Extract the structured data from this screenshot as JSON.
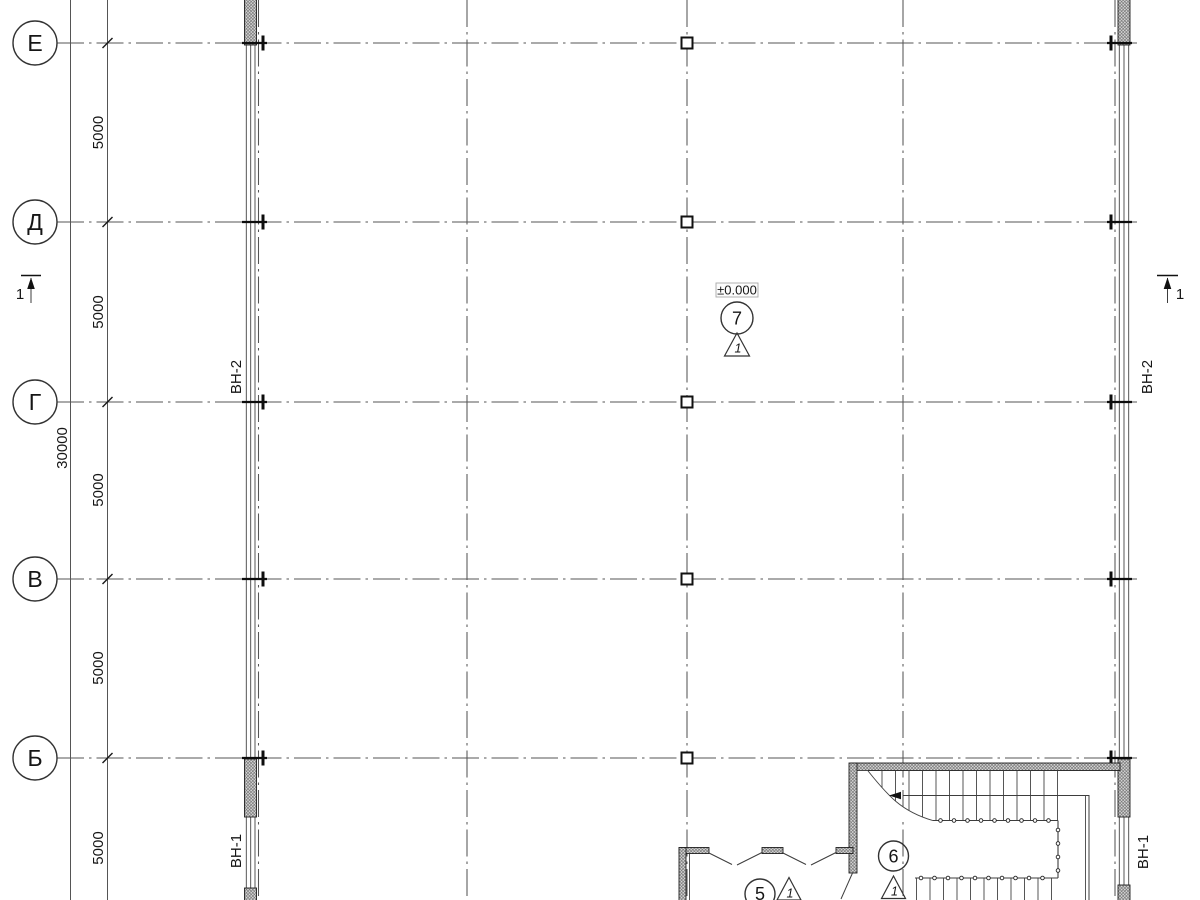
{
  "axes": {
    "labels": [
      "Е",
      "Д",
      "Г",
      "В",
      "Б"
    ]
  },
  "dimensions": {
    "bay": "5000",
    "overall": "30000"
  },
  "window_marks": {
    "vn2": "ВН-2",
    "vn1": "ВН-1"
  },
  "elevation": {
    "value": "±0.000"
  },
  "room_markers": {
    "m7": "7",
    "m6": "6",
    "m5": "5"
  },
  "detail_triangle": {
    "label": "1"
  },
  "section_mark": {
    "label": "1"
  }
}
